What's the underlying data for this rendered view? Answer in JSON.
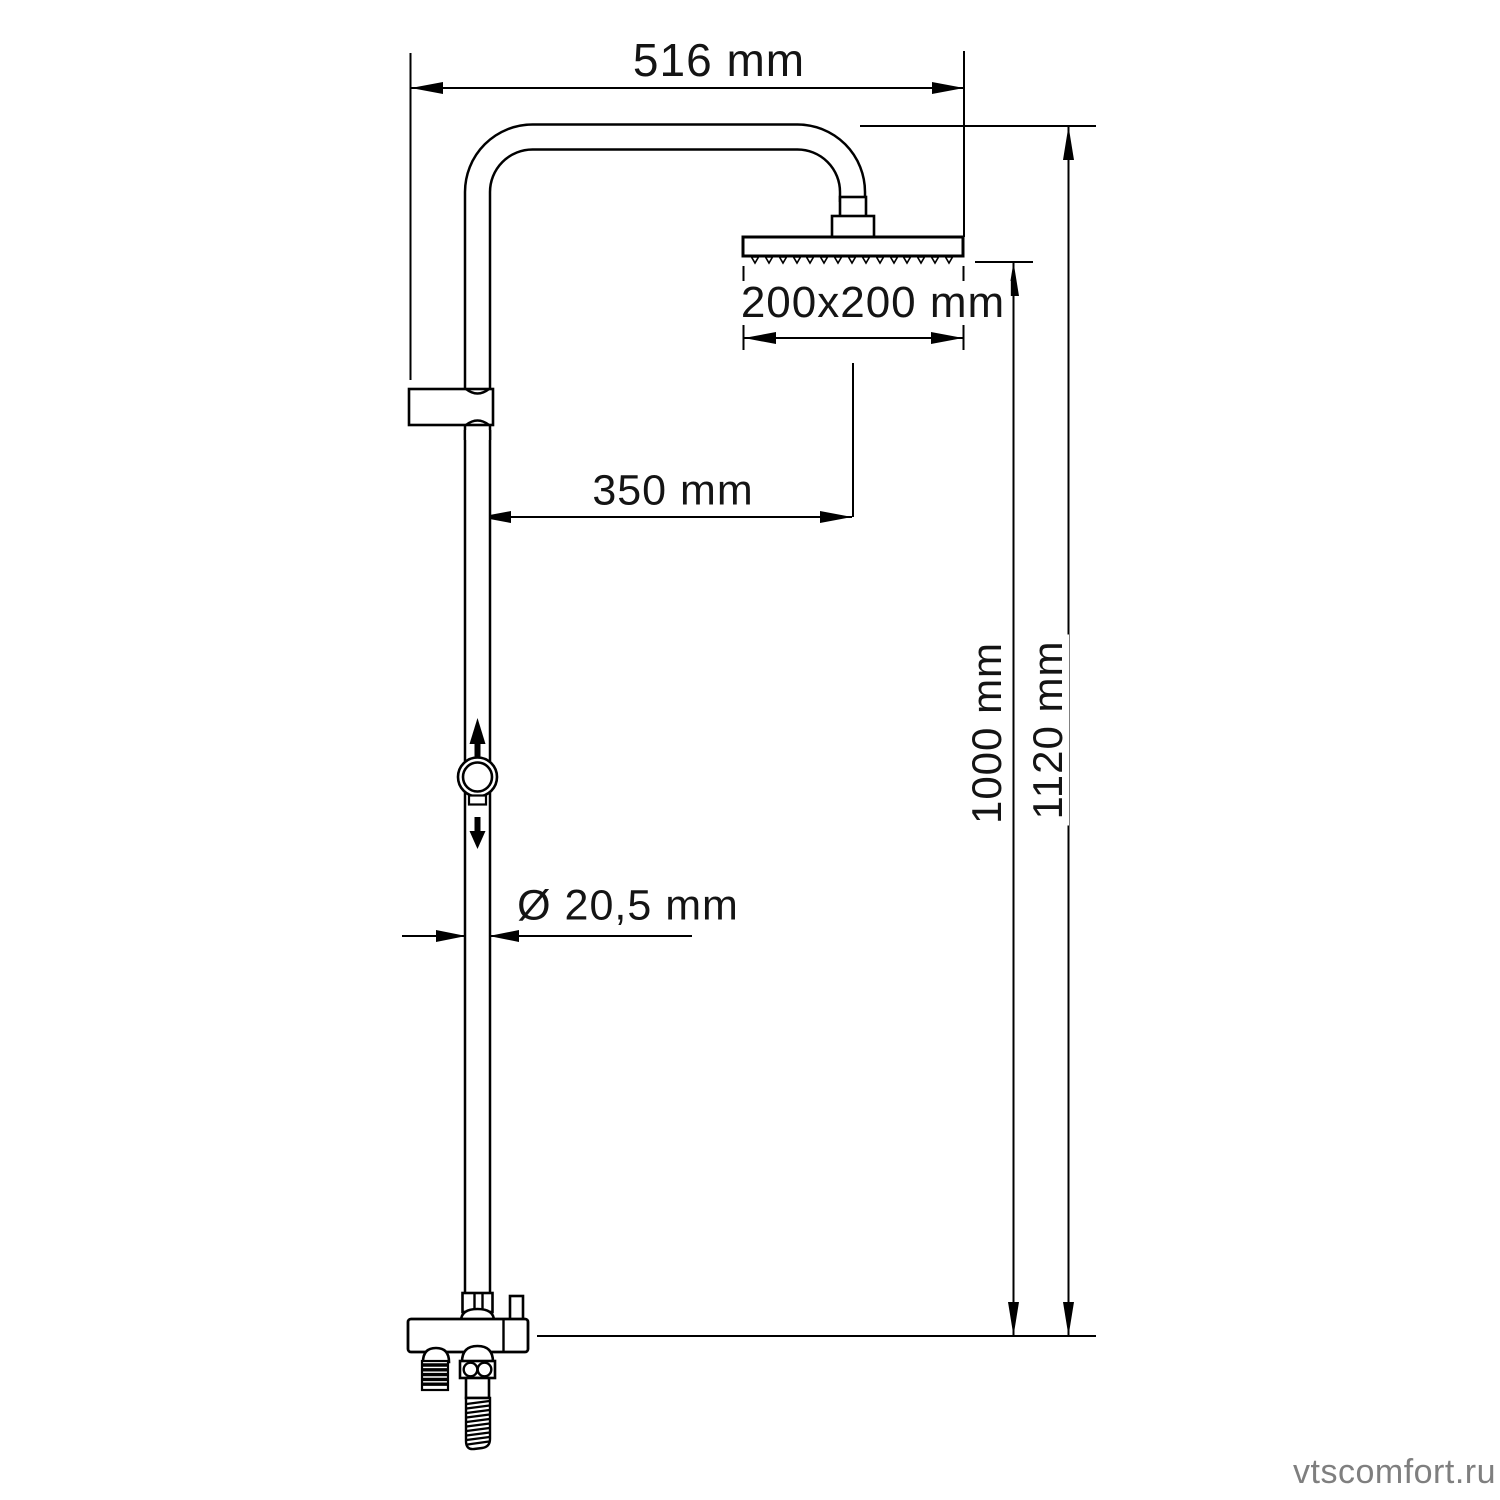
{
  "diagram": {
    "type": "technical-drawing",
    "subject": "shower-column-with-overhead-shower",
    "colors": {
      "line": "#000000",
      "background": "#ffffff",
      "watermark": "#7f7f7f"
    }
  },
  "dimensions": {
    "arm_reach": "516 mm",
    "head_size": "200x200 mm",
    "head_offset": "350 mm",
    "pipe_diameter": "Ø 20,5 mm",
    "riser_height": "1000 mm",
    "overall_height": "1120 mm"
  },
  "watermark": {
    "text": "vtscomfort.ru"
  }
}
